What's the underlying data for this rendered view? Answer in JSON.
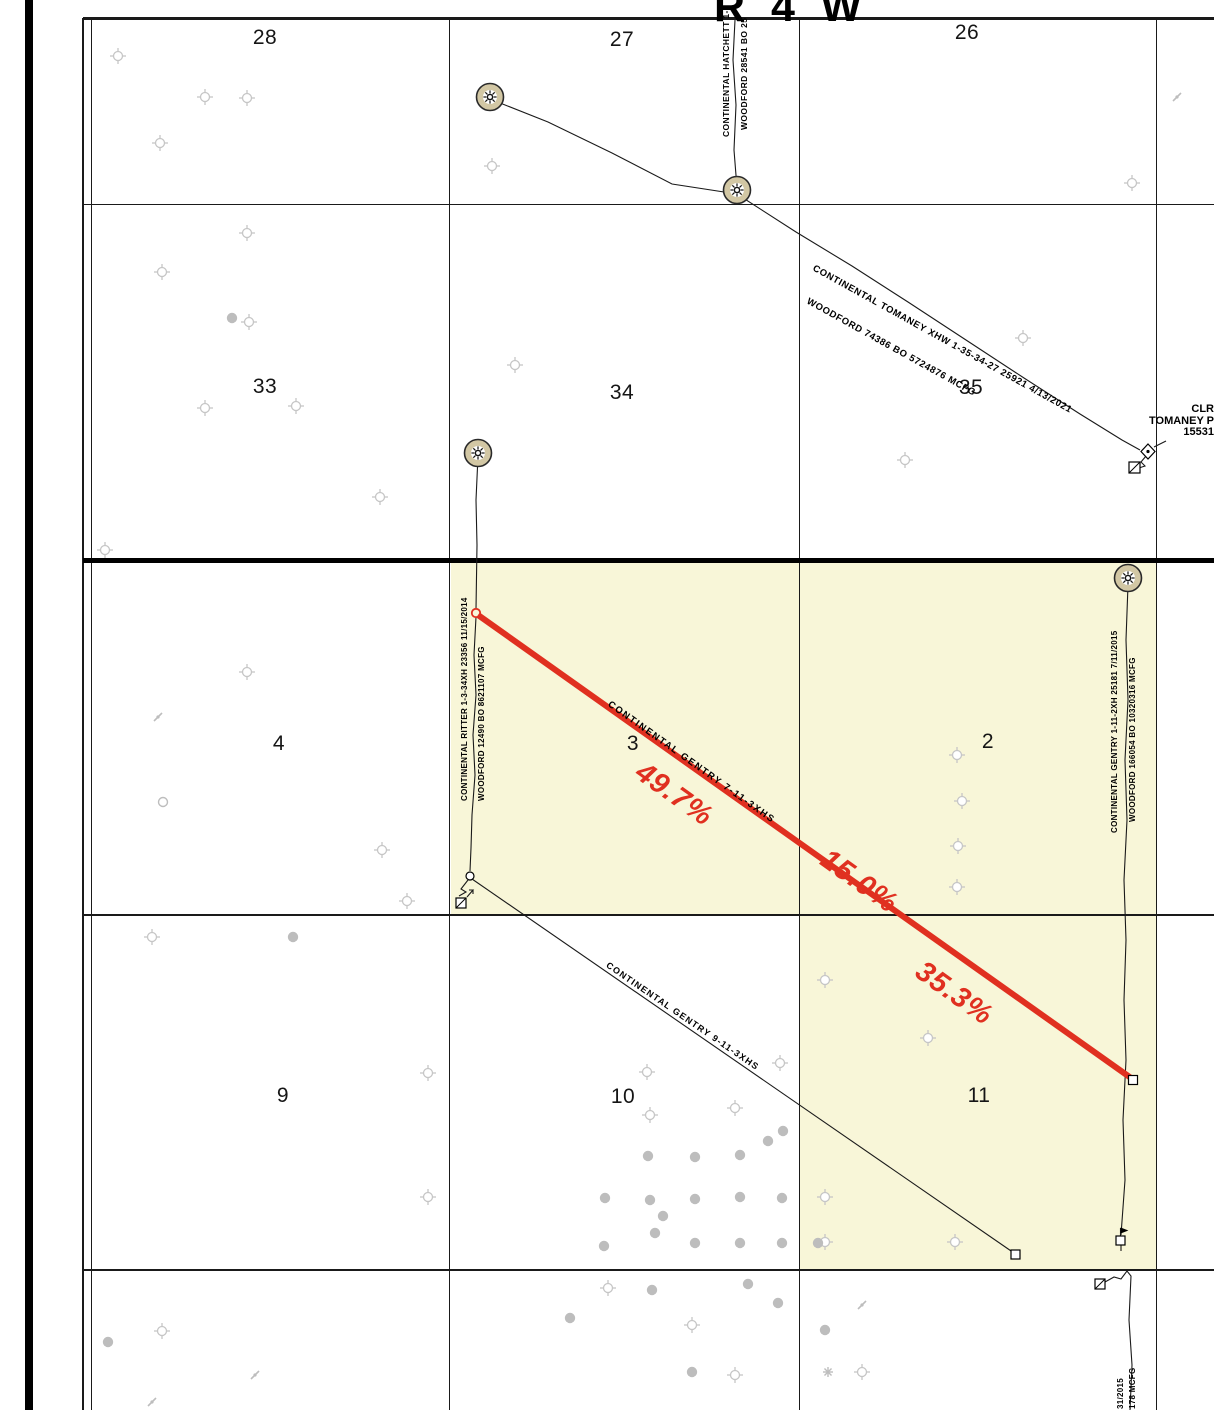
{
  "title": "R 4 W",
  "sections": [
    {
      "label": "28",
      "x": 265,
      "y": 38
    },
    {
      "label": "27",
      "x": 622,
      "y": 40
    },
    {
      "label": "26",
      "x": 967,
      "y": 33
    },
    {
      "label": "33",
      "x": 265,
      "y": 387
    },
    {
      "label": "34",
      "x": 622,
      "y": 393
    },
    {
      "label": "35",
      "x": 971,
      "y": 388
    },
    {
      "label": "4",
      "x": 279,
      "y": 744
    },
    {
      "label": "3",
      "x": 633,
      "y": 744
    },
    {
      "label": "2",
      "x": 988,
      "y": 742
    },
    {
      "label": "9",
      "x": 283,
      "y": 1096
    },
    {
      "label": "10",
      "x": 623,
      "y": 1097
    },
    {
      "label": "11",
      "x": 979,
      "y": 1096
    }
  ],
  "wells": {
    "hatchett": {
      "label_line1": "CONTINENTAL HATCHETT 1-2",
      "label_line2": "WOODFORD 28541 BO 25"
    },
    "tomaney": {
      "label_line1": "CONTINENTAL TOMANEY XHW 1-35-34-27 25921 4/13/2021",
      "label_line2": "WOODFORD 74386 BO 5724876 MCFG"
    },
    "tomaney_p": {
      "line1": "CLR",
      "line2": "TOMANEY P",
      "line3": "15531"
    },
    "ritter": {
      "label_line1": "CONTINENTAL RITTER 1-3-34XH 23356 11/15/2014",
      "label_line2": "WOODFORD 12490 BO 8621107 MCFG"
    },
    "gentry_7_11": {
      "name": "CONTINENTAL GENTRY 7-11-3XHS",
      "allocations": [
        "49.7%",
        "15.0%",
        "35.3%"
      ]
    },
    "gentry_9_11": {
      "name": "CONTINENTAL GENTRY 9-11-3XHS"
    },
    "gentry_1_11": {
      "label_line1": "CONTINENTAL GENTRY 1-11-2XH 25181 7/11/2015",
      "label_line2": "WOODFORD 166054 BO 10320316 MCFG"
    },
    "bottom_edge_partial": {
      "line1": "31/2015",
      "line2": "178 MCFG"
    }
  },
  "colors": {
    "highlight": "#f8f6d8",
    "lateral_red": "#e03020",
    "symbol_gray": "#c6c6c6",
    "dot_gray": "#bdbdbd",
    "well_tan": "#d2c7a4",
    "line_black": "#1a1a1a"
  },
  "symbols": {
    "gas_wells": [
      [
        490,
        97
      ],
      [
        737,
        190
      ],
      [
        478,
        453
      ],
      [
        1128,
        578
      ]
    ],
    "staked_locations": [
      [
        118,
        56
      ],
      [
        205,
        97
      ],
      [
        247,
        98
      ],
      [
        160,
        143
      ],
      [
        492,
        166
      ],
      [
        1132,
        183
      ],
      [
        247,
        233
      ],
      [
        162,
        272
      ],
      [
        249,
        322
      ],
      [
        515,
        365
      ],
      [
        205,
        408
      ],
      [
        296,
        406
      ],
      [
        1023,
        338
      ],
      [
        905,
        460
      ],
      [
        380,
        497
      ],
      [
        105,
        550
      ],
      [
        247,
        672
      ],
      [
        957,
        755
      ],
      [
        962,
        801
      ],
      [
        958,
        846
      ],
      [
        957,
        887
      ],
      [
        382,
        850
      ],
      [
        407,
        901
      ],
      [
        152,
        937
      ],
      [
        428,
        1073
      ],
      [
        647,
        1072
      ],
      [
        650,
        1115
      ],
      [
        735,
        1108
      ],
      [
        780,
        1063
      ],
      [
        825,
        980
      ],
      [
        928,
        1038
      ],
      [
        428,
        1197
      ],
      [
        825,
        1197
      ],
      [
        825,
        1242
      ],
      [
        955,
        1242
      ],
      [
        608,
        1288
      ],
      [
        692,
        1325
      ],
      [
        735,
        1375
      ],
      [
        862,
        1372
      ],
      [
        162,
        1331
      ]
    ],
    "well_dots": [
      [
        232,
        318
      ],
      [
        293,
        937
      ],
      [
        783,
        1131
      ],
      [
        768,
        1141
      ],
      [
        648,
        1156
      ],
      [
        695,
        1157
      ],
      [
        740,
        1155
      ],
      [
        605,
        1198
      ],
      [
        650,
        1200
      ],
      [
        695,
        1199
      ],
      [
        740,
        1197
      ],
      [
        782,
        1198
      ],
      [
        663,
        1216
      ],
      [
        655,
        1233
      ],
      [
        604,
        1246
      ],
      [
        695,
        1243
      ],
      [
        740,
        1243
      ],
      [
        782,
        1243
      ],
      [
        570,
        1318
      ],
      [
        652,
        1290
      ],
      [
        748,
        1284
      ],
      [
        778,
        1303
      ],
      [
        692,
        1372
      ],
      [
        825,
        1330
      ],
      [
        108,
        1342
      ],
      [
        818,
        1243
      ]
    ],
    "open_circles": [
      [
        163,
        802
      ]
    ],
    "slashes": [
      [
        158,
        717
      ],
      [
        1177,
        97
      ],
      [
        255,
        1375
      ],
      [
        862,
        1305
      ],
      [
        152,
        1402
      ]
    ],
    "stars": [
      [
        828,
        1372
      ]
    ]
  }
}
